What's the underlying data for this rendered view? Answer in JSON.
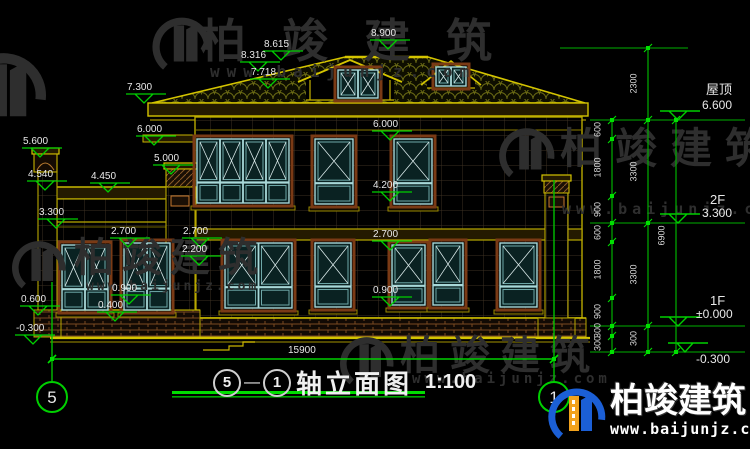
{
  "title_bar": {
    "axis_from": "5",
    "axis_to": "1",
    "drawing_name": "轴立面图",
    "scale": "1:100"
  },
  "watermark": {
    "brand": "柏竣建筑",
    "site": "www.baijunjz.com"
  },
  "labels": [
    {
      "t": "8.615",
      "x": 264,
      "y": 40,
      "m": 1
    },
    {
      "t": "8.316",
      "x": 241,
      "y": 51,
      "m": 1
    },
    {
      "t": "7.718",
      "x": 251,
      "y": 68,
      "m": 1
    },
    {
      "t": "8.900",
      "x": 371,
      "y": 29,
      "m": 1
    },
    {
      "t": "7.300",
      "x": 127,
      "y": 83,
      "m": 1
    },
    {
      "t": "6.000",
      "x": 137,
      "y": 125,
      "m": 1
    },
    {
      "t": "5.600",
      "x": 23,
      "y": 137,
      "m": 1
    },
    {
      "t": "5.000",
      "x": 154,
      "y": 154,
      "m": 1
    },
    {
      "t": "4.540",
      "x": 28,
      "y": 170,
      "m": 1
    },
    {
      "t": "4.450",
      "x": 91,
      "y": 172,
      "m": 1
    },
    {
      "t": "3.300",
      "x": 39,
      "y": 208,
      "m": 1
    },
    {
      "t": "2.700",
      "x": 111,
      "y": 227,
      "m": 1
    },
    {
      "t": "2.700",
      "x": 183,
      "y": 227,
      "m": 1
    },
    {
      "t": "2.200",
      "x": 182,
      "y": 245,
      "m": 1
    },
    {
      "t": "0.600",
      "x": 21,
      "y": 295,
      "m": 1
    },
    {
      "t": "0.900",
      "x": 112,
      "y": 284,
      "m": 1
    },
    {
      "t": "0.400",
      "x": 98,
      "y": 301,
      "m": 1
    },
    {
      "t": "-0.300",
      "x": 16,
      "y": 324,
      "m": 1
    },
    {
      "t": "6.000",
      "x": 373,
      "y": 120,
      "m": 1
    },
    {
      "t": "4.200",
      "x": 373,
      "y": 181,
      "m": 1
    },
    {
      "t": "2.700",
      "x": 373,
      "y": 230,
      "m": 1
    },
    {
      "t": "0.900",
      "x": 373,
      "y": 286,
      "m": 1
    },
    {
      "t": "屋顶",
      "x": 706,
      "y": 83,
      "m": 0,
      "s": 13
    },
    {
      "t": "6.600",
      "x": 702,
      "y": 99,
      "m": 0,
      "s": 12
    },
    {
      "t": "2F",
      "x": 710,
      "y": 193,
      "m": 0,
      "s": 13
    },
    {
      "t": "3.300",
      "x": 702,
      "y": 207,
      "m": 0,
      "s": 12
    },
    {
      "t": "1F",
      "x": 710,
      "y": 294,
      "m": 0,
      "s": 13
    },
    {
      "t": "±0.000",
      "x": 696,
      "y": 308,
      "m": 0,
      "s": 12
    },
    {
      "t": "-0.300",
      "x": 696,
      "y": 353,
      "m": 0,
      "s": 12
    },
    {
      "t": "15900",
      "x": 288,
      "y": 346,
      "m": 0
    }
  ],
  "dim_chains": [
    {
      "x": 612,
      "ticks": [
        120,
        139,
        196,
        223,
        242,
        298,
        326,
        336,
        352
      ],
      "texts": [
        "600",
        "1800",
        "900",
        "600",
        "1800",
        "900",
        "300",
        "300"
      ]
    },
    {
      "x": 648,
      "ticks": [
        48,
        120,
        223,
        326,
        352
      ],
      "texts": [
        "2300",
        "3300",
        "3300",
        "300"
      ]
    },
    {
      "x": 676,
      "ticks": [
        120,
        352
      ],
      "texts": [
        "6900"
      ]
    }
  ],
  "axis_bubbles": [
    {
      "n": "5",
      "x": 52,
      "y": 397
    },
    {
      "n": "1",
      "x": 554,
      "y": 397
    }
  ],
  "colors": {
    "annotation_green": "#00d000",
    "dim_text": "#e8e8e8",
    "outline_yellow": "#d4c400",
    "window_frame_brown": "#7a3a15",
    "window_glass_teal": "#a8d8d8",
    "watermark_dark": "#2e2e2e",
    "logo_blue": "#1b5fd6",
    "logo_orange": "#f2a21c"
  }
}
